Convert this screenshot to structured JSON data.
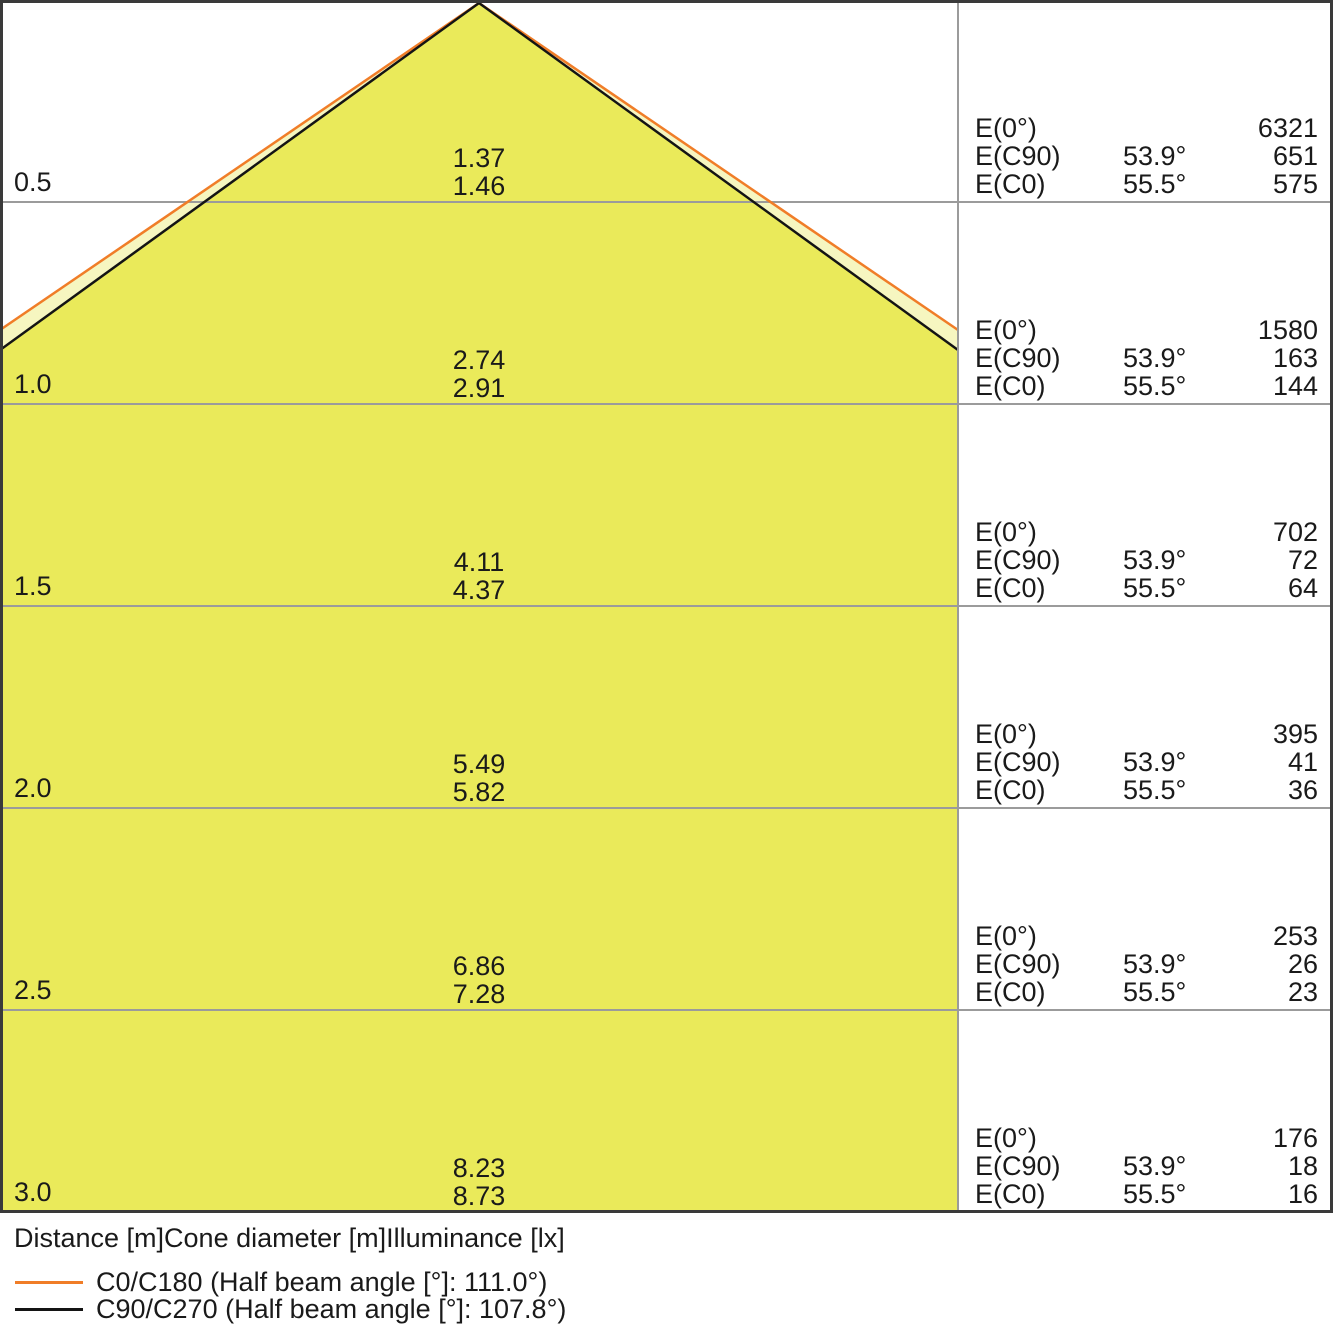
{
  "chart_data": {
    "type": "area",
    "subtype": "photometric-light-cone-diagram",
    "xlabel": "Distance [m]",
    "x": [
      0.5,
      1.0,
      1.5,
      2.0,
      2.5,
      3.0
    ],
    "grid": true,
    "legend_position": "bottom-left",
    "series": [
      {
        "name": "C0/C180 cone diameter [m]",
        "half_beam_angle_deg": 111.0,
        "values": [
          1.46,
          2.91,
          4.37,
          5.82,
          7.28,
          8.73
        ]
      },
      {
        "name": "C90/C270 cone diameter [m]",
        "half_beam_angle_deg": 107.8,
        "values": [
          1.37,
          2.74,
          4.11,
          5.49,
          6.86,
          8.23
        ]
      },
      {
        "name": "E(0°) illuminance [lx]",
        "values": [
          6321,
          1580,
          702,
          395,
          253,
          176
        ]
      },
      {
        "name": "E(C90) illuminance at 53.9° [lx]",
        "values": [
          651,
          163,
          72,
          41,
          26,
          18
        ]
      },
      {
        "name": "E(C0) illuminance at 55.5° [lx]",
        "values": [
          575,
          144,
          64,
          36,
          23,
          16
        ]
      }
    ]
  },
  "colors": {
    "cone_inner_fill": "#EAEA5A",
    "cone_outer_fill": "#F6F6C0",
    "c0_line": "#F07D28",
    "c90_line": "#141414",
    "gridline": "#9B9B9B",
    "border": "#3A3A3A"
  },
  "panel_labels": {
    "e0": "E(0°)",
    "ec90": "E(C90)",
    "ec0": "E(C0)"
  },
  "rows": [
    {
      "distance": "0.5",
      "cone_c90": "1.37",
      "cone_c0": "1.46",
      "e0": "6321",
      "ec90_angle": "53.9°",
      "ec90": "651",
      "ec0_angle": "55.5°",
      "ec0": "575"
    },
    {
      "distance": "1.0",
      "cone_c90": "2.74",
      "cone_c0": "2.91",
      "e0": "1580",
      "ec90_angle": "53.9°",
      "ec90": "163",
      "ec0_angle": "55.5°",
      "ec0": "144"
    },
    {
      "distance": "1.5",
      "cone_c90": "4.11",
      "cone_c0": "4.37",
      "e0": "702",
      "ec90_angle": "53.9°",
      "ec90": "72",
      "ec0_angle": "55.5°",
      "ec0": "64"
    },
    {
      "distance": "2.0",
      "cone_c90": "5.49",
      "cone_c0": "5.82",
      "e0": "395",
      "ec90_angle": "53.9°",
      "ec90": "41",
      "ec0_angle": "55.5°",
      "ec0": "36"
    },
    {
      "distance": "2.5",
      "cone_c90": "6.86",
      "cone_c0": "7.28",
      "e0": "253",
      "ec90_angle": "53.9°",
      "ec90": "26",
      "ec0_angle": "55.5°",
      "ec0": "23"
    },
    {
      "distance": "3.0",
      "cone_c90": "8.23",
      "cone_c0": "8.73",
      "e0": "176",
      "ec90_angle": "53.9°",
      "ec90": "18",
      "ec0_angle": "55.5°",
      "ec0": "16"
    }
  ],
  "footer": {
    "axis_caption": "Distance [m]Cone diameter [m]Illuminance [lx]",
    "legend": [
      {
        "label": "C0/C180 (Half beam angle [°]: 111.0°)",
        "color": "#F07D28"
      },
      {
        "label": "C90/C270 (Half beam angle [°]: 107.8°)",
        "color": "#141414"
      }
    ]
  }
}
